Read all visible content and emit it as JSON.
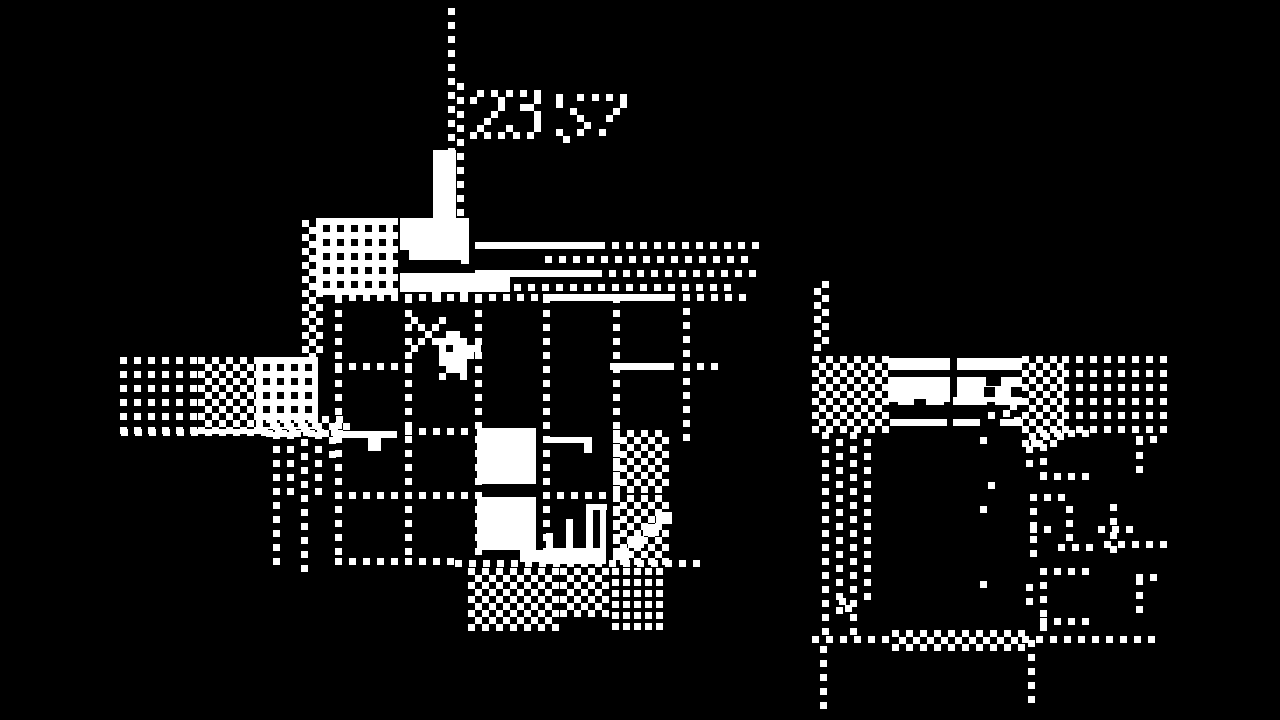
{
  "canvas": {
    "w": 1280,
    "h": 720,
    "bg": "#000000",
    "fg": "#ffffff"
  },
  "hud": {
    "timer_text": "23 57",
    "timer_primary": "23",
    "timer_secondary": "57"
  },
  "sprites": {
    "player": {
      "x": 404,
      "y": 310,
      "cell": 7,
      "rows": [
        "............",
        ".#...#......",
        "..#.#.......",
        "...#..##....",
        "..#.#####...",
        ".#...#.####.",
        ".....#####..",
        ".....####...",
        "......###...",
        ".....#..#..."
      ]
    },
    "digit_2": {
      "x": 470,
      "y": 90,
      "cell": 7,
      "rows": [
        ".#.#.",
        "#...#",
        "....#",
        "...#.",
        "..#..",
        ".#...",
        "#.#.#"
      ]
    },
    "digit_3": {
      "x": 506,
      "y": 90,
      "cell": 7,
      "rows": [
        "#.#.#",
        "....#",
        "..##.",
        "....#",
        "....#",
        "#...#",
        ".#.#."
      ]
    },
    "digit_5": {
      "x": 556,
      "y": 94,
      "cell": 7,
      "rows": [
        "#..#.",
        "#....",
        "..#..",
        "...#.",
        "....#",
        "#..#.",
        ".#..."
      ]
    },
    "digit_7": {
      "x": 592,
      "y": 94,
      "cell": 7,
      "rows": [
        "#.#.#",
        "....#",
        "...#.",
        "..#..",
        ".....",
        ".#...",
        "....."
      ]
    }
  },
  "scene": {
    "elements": [
      {
        "t": "dsv",
        "x": 448,
        "y": 8,
        "h": 148
      },
      {
        "t": "dsv",
        "x": 457,
        "y": 83,
        "h": 147
      },
      {
        "t": "r",
        "x": 433,
        "y": 150,
        "w": 23,
        "h": 72,
        "c": "w"
      },
      {
        "t": "r",
        "x": 400,
        "y": 218,
        "w": 63,
        "h": 42,
        "c": "w"
      },
      {
        "t": "r",
        "x": 400,
        "y": 250,
        "w": 9,
        "h": 10,
        "c": "b"
      },
      {
        "t": "r",
        "x": 461,
        "y": 218,
        "w": 8,
        "h": 46,
        "c": "w"
      },
      {
        "t": "r",
        "x": 400,
        "y": 273,
        "w": 110,
        "h": 19,
        "c": "w"
      },
      {
        "t": "r",
        "x": 432,
        "y": 288,
        "w": 9,
        "h": 14,
        "c": "w"
      },
      {
        "t": "r",
        "x": 460,
        "y": 288,
        "w": 8,
        "h": 14,
        "c": "w"
      },
      {
        "t": "ck",
        "x": 302,
        "y": 220,
        "w": 16,
        "h": 140
      },
      {
        "t": "iv",
        "x": 316,
        "y": 218,
        "w": 82,
        "h": 77
      },
      {
        "t": "r",
        "x": 475,
        "y": 242,
        "w": 130,
        "h": 7,
        "c": "w"
      },
      {
        "t": "dsh",
        "x": 612,
        "y": 242,
        "w": 152
      },
      {
        "t": "dsh",
        "x": 545,
        "y": 256,
        "w": 206
      },
      {
        "t": "r",
        "x": 475,
        "y": 270,
        "w": 127,
        "h": 7,
        "c": "w"
      },
      {
        "t": "dsh",
        "x": 609,
        "y": 270,
        "w": 141
      },
      {
        "t": "dsh",
        "x": 514,
        "y": 284,
        "w": 224
      },
      {
        "t": "dsh",
        "x": 335,
        "y": 294,
        "w": 208
      },
      {
        "t": "r",
        "x": 543,
        "y": 294,
        "w": 132,
        "h": 7,
        "c": "w"
      },
      {
        "t": "dsh",
        "x": 683,
        "y": 294,
        "w": 60
      },
      {
        "t": "dg",
        "x": 120,
        "y": 357,
        "w": 78,
        "h": 72
      },
      {
        "t": "ck",
        "x": 198,
        "y": 357,
        "w": 58,
        "h": 72
      },
      {
        "t": "iv",
        "x": 256,
        "y": 357,
        "w": 62,
        "h": 72
      },
      {
        "t": "dsh",
        "x": 121,
        "y": 429,
        "w": 224
      },
      {
        "t": "ck",
        "x": 266,
        "y": 416,
        "w": 82,
        "h": 16
      },
      {
        "t": "dsv",
        "x": 273,
        "y": 432,
        "h": 136
      },
      {
        "t": "dsv",
        "x": 287,
        "y": 432,
        "h": 68
      },
      {
        "t": "dsv",
        "x": 301,
        "y": 425,
        "h": 143
      },
      {
        "t": "dsv",
        "x": 315,
        "y": 432,
        "h": 68
      },
      {
        "t": "dsv",
        "x": 329,
        "y": 423,
        "h": 36
      },
      {
        "t": "dsv",
        "x": 335,
        "y": 296,
        "h": 264
      },
      {
        "t": "dsv",
        "x": 405,
        "y": 296,
        "h": 260
      },
      {
        "t": "dsv",
        "x": 475,
        "y": 296,
        "h": 262
      },
      {
        "t": "dsv",
        "x": 543,
        "y": 296,
        "h": 262
      },
      {
        "t": "dsv",
        "x": 613,
        "y": 296,
        "h": 262
      },
      {
        "t": "dsv",
        "x": 683,
        "y": 294,
        "h": 146
      },
      {
        "t": "dsh",
        "x": 335,
        "y": 363,
        "w": 78
      },
      {
        "t": "r",
        "x": 610,
        "y": 363,
        "w": 64,
        "h": 7,
        "c": "w"
      },
      {
        "t": "dsh",
        "x": 683,
        "y": 363,
        "w": 30
      },
      {
        "t": "r",
        "x": 333,
        "y": 431,
        "w": 64,
        "h": 7,
        "c": "w"
      },
      {
        "t": "r",
        "x": 368,
        "y": 438,
        "w": 13,
        "h": 13,
        "c": "w"
      },
      {
        "t": "dsh",
        "x": 405,
        "y": 428,
        "w": 70
      },
      {
        "t": "r",
        "x": 545,
        "y": 437,
        "w": 47,
        "h": 6,
        "c": "w"
      },
      {
        "t": "r",
        "x": 584,
        "y": 443,
        "w": 8,
        "h": 10,
        "c": "w"
      },
      {
        "t": "dsh",
        "x": 335,
        "y": 492,
        "w": 140
      },
      {
        "t": "dsh",
        "x": 543,
        "y": 492,
        "w": 70
      },
      {
        "t": "dsh",
        "x": 335,
        "y": 558,
        "w": 118
      },
      {
        "t": "dsh",
        "x": 455,
        "y": 560,
        "w": 240
      },
      {
        "t": "r",
        "x": 477,
        "y": 428,
        "w": 59,
        "h": 56,
        "c": "w"
      },
      {
        "t": "r",
        "x": 477,
        "y": 497,
        "w": 59,
        "h": 53,
        "c": "w"
      },
      {
        "t": "r",
        "x": 520,
        "y": 550,
        "w": 30,
        "h": 12,
        "c": "w"
      },
      {
        "t": "r",
        "x": 546,
        "y": 548,
        "w": 60,
        "h": 16,
        "c": "w"
      },
      {
        "t": "r",
        "x": 546,
        "y": 533,
        "w": 7,
        "h": 31,
        "c": "w"
      },
      {
        "t": "r",
        "x": 566,
        "y": 519,
        "w": 7,
        "h": 45,
        "c": "w"
      },
      {
        "t": "r",
        "x": 586,
        "y": 504,
        "w": 7,
        "h": 60,
        "c": "w"
      },
      {
        "t": "r",
        "x": 600,
        "y": 504,
        "w": 6,
        "h": 60,
        "c": "w"
      },
      {
        "t": "r",
        "x": 586,
        "y": 504,
        "w": 21,
        "h": 6,
        "c": "w"
      },
      {
        "t": "ck",
        "x": 613,
        "y": 430,
        "w": 52,
        "h": 60
      },
      {
        "t": "ck",
        "x": 613,
        "y": 495,
        "w": 52,
        "h": 64
      },
      {
        "t": "r",
        "x": 613,
        "y": 548,
        "w": 16,
        "h": 12,
        "c": "w"
      },
      {
        "t": "r",
        "x": 628,
        "y": 536,
        "w": 16,
        "h": 12,
        "c": "w"
      },
      {
        "t": "r",
        "x": 643,
        "y": 524,
        "w": 16,
        "h": 12,
        "c": "w"
      },
      {
        "t": "r",
        "x": 656,
        "y": 512,
        "w": 16,
        "h": 12,
        "c": "w"
      },
      {
        "t": "ck",
        "x": 468,
        "y": 568,
        "w": 90,
        "h": 58
      },
      {
        "t": "ck",
        "x": 560,
        "y": 568,
        "w": 47,
        "h": 45
      },
      {
        "t": "dn",
        "x": 612,
        "y": 568,
        "w": 53,
        "h": 58
      },
      {
        "t": "dsv",
        "x": 814,
        "y": 288,
        "h": 70
      },
      {
        "t": "dsv",
        "x": 822,
        "y": 281,
        "h": 70
      },
      {
        "t": "ck",
        "x": 812,
        "y": 356,
        "w": 76,
        "h": 72
      },
      {
        "t": "r",
        "x": 888,
        "y": 358,
        "w": 134,
        "h": 44,
        "c": "w"
      },
      {
        "t": "r",
        "x": 888,
        "y": 370,
        "w": 134,
        "h": 7,
        "c": "b"
      },
      {
        "t": "r",
        "x": 950,
        "y": 358,
        "w": 7,
        "h": 44,
        "c": "b"
      },
      {
        "t": "r",
        "x": 986,
        "y": 373,
        "w": 15,
        "h": 13,
        "c": "b"
      },
      {
        "t": "r",
        "x": 984,
        "y": 387,
        "w": 11,
        "h": 10,
        "c": "b"
      },
      {
        "t": "r",
        "x": 1011,
        "y": 387,
        "w": 11,
        "h": 10,
        "c": "b"
      },
      {
        "t": "r",
        "x": 898,
        "y": 397,
        "w": 46,
        "h": 8,
        "c": "w"
      },
      {
        "t": "r",
        "x": 914,
        "y": 399,
        "w": 12,
        "h": 6,
        "c": "b"
      },
      {
        "t": "r",
        "x": 953,
        "y": 397,
        "w": 34,
        "h": 8,
        "c": "w"
      },
      {
        "t": "r",
        "x": 995,
        "y": 397,
        "w": 27,
        "h": 8,
        "c": "w"
      },
      {
        "t": "r",
        "x": 890,
        "y": 419,
        "w": 57,
        "h": 7,
        "c": "w"
      },
      {
        "t": "r",
        "x": 953,
        "y": 419,
        "w": 27,
        "h": 7,
        "c": "w"
      },
      {
        "t": "r",
        "x": 1000,
        "y": 419,
        "w": 23,
        "h": 7,
        "c": "w"
      },
      {
        "t": "r",
        "x": 1003,
        "y": 410,
        "w": 7,
        "h": 7,
        "c": "w"
      },
      {
        "t": "r",
        "x": 1014,
        "y": 417,
        "w": 7,
        "h": 7,
        "c": "w"
      },
      {
        "t": "r",
        "x": 1010,
        "y": 403,
        "w": 7,
        "h": 7,
        "c": "w"
      },
      {
        "t": "ck",
        "x": 1022,
        "y": 356,
        "w": 40,
        "h": 86
      },
      {
        "t": "dg",
        "x": 1062,
        "y": 356,
        "w": 100,
        "h": 76
      },
      {
        "t": "dsv",
        "x": 822,
        "y": 432,
        "h": 202
      },
      {
        "t": "dsv",
        "x": 836,
        "y": 439,
        "h": 175
      },
      {
        "t": "dsv",
        "x": 850,
        "y": 432,
        "h": 202
      },
      {
        "t": "dsv",
        "x": 864,
        "y": 439,
        "h": 160
      },
      {
        "t": "r",
        "x": 839,
        "y": 598,
        "w": 7,
        "h": 7,
        "c": "w"
      },
      {
        "t": "r",
        "x": 845,
        "y": 605,
        "w": 7,
        "h": 7,
        "c": "w"
      },
      {
        "t": "r",
        "x": 980,
        "y": 437,
        "w": 7,
        "h": 7,
        "c": "w"
      },
      {
        "t": "r",
        "x": 988,
        "y": 482,
        "w": 7,
        "h": 7,
        "c": "w"
      },
      {
        "t": "r",
        "x": 980,
        "y": 506,
        "w": 7,
        "h": 7,
        "c": "w"
      },
      {
        "t": "r",
        "x": 980,
        "y": 581,
        "w": 7,
        "h": 7,
        "c": "w"
      },
      {
        "t": "r",
        "x": 988,
        "y": 412,
        "w": 7,
        "h": 7,
        "c": "w"
      },
      {
        "t": "dsh",
        "x": 812,
        "y": 636,
        "w": 82
      },
      {
        "t": "ck",
        "x": 892,
        "y": 630,
        "w": 130,
        "h": 16
      },
      {
        "t": "dsh",
        "x": 1022,
        "y": 636,
        "w": 140
      },
      {
        "t": "dsv",
        "x": 820,
        "y": 646,
        "h": 60
      },
      {
        "t": "dsv",
        "x": 1040,
        "y": 430,
        "h": 52
      },
      {
        "t": "dsh",
        "x": 1040,
        "y": 430,
        "w": 54
      },
      {
        "t": "dsh",
        "x": 1040,
        "y": 473,
        "w": 54
      },
      {
        "t": "dsv",
        "x": 1026,
        "y": 446,
        "h": 23
      },
      {
        "t": "r",
        "x": 1031,
        "y": 440,
        "w": 7,
        "h": 7,
        "c": "w"
      },
      {
        "t": "dsv",
        "x": 1136,
        "y": 438,
        "h": 32
      },
      {
        "t": "dsh",
        "x": 1136,
        "y": 436,
        "w": 24
      },
      {
        "t": "dsv",
        "x": 1030,
        "y": 494,
        "h": 62
      },
      {
        "t": "dsh",
        "x": 1030,
        "y": 494,
        "w": 30
      },
      {
        "t": "dsh",
        "x": 1030,
        "y": 526,
        "w": 24
      },
      {
        "t": "dsv",
        "x": 1066,
        "y": 506,
        "h": 42
      },
      {
        "t": "dsh",
        "x": 1058,
        "y": 544,
        "w": 36
      },
      {
        "t": "dsv",
        "x": 1110,
        "y": 504,
        "h": 50
      },
      {
        "t": "dsh",
        "x": 1098,
        "y": 526,
        "w": 34
      },
      {
        "t": "dsh",
        "x": 1104,
        "y": 541,
        "w": 58
      },
      {
        "t": "dsv",
        "x": 1026,
        "y": 584,
        "h": 23
      },
      {
        "t": "dsv",
        "x": 1040,
        "y": 568,
        "h": 58
      },
      {
        "t": "dsh",
        "x": 1040,
        "y": 568,
        "w": 54
      },
      {
        "t": "dsh",
        "x": 1040,
        "y": 618,
        "w": 54
      },
      {
        "t": "dsv",
        "x": 1136,
        "y": 578,
        "h": 32
      },
      {
        "t": "dsh",
        "x": 1136,
        "y": 574,
        "w": 24
      },
      {
        "t": "dsv",
        "x": 1028,
        "y": 640,
        "h": 64
      }
    ]
  }
}
